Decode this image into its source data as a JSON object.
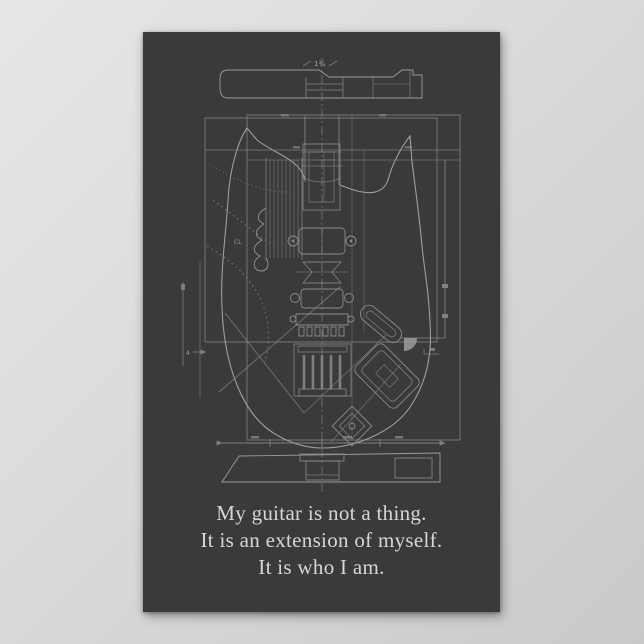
{
  "page": {
    "background_top_color": "#e6e6e6",
    "background_bottom_color": "#c9c9c9"
  },
  "poster": {
    "background_color": "#3a3a3a",
    "line_color": "#8c8c8c",
    "quote_color": "#d6d6d6"
  },
  "blueprint": {
    "annotations": {
      "top_dimension": "1¾",
      "left_dimension": "4",
      "centerline_mark": "CL"
    }
  },
  "quote": {
    "lines": [
      "My guitar is not a thing.",
      "It is an extension of myself.",
      "It is who I am."
    ]
  }
}
